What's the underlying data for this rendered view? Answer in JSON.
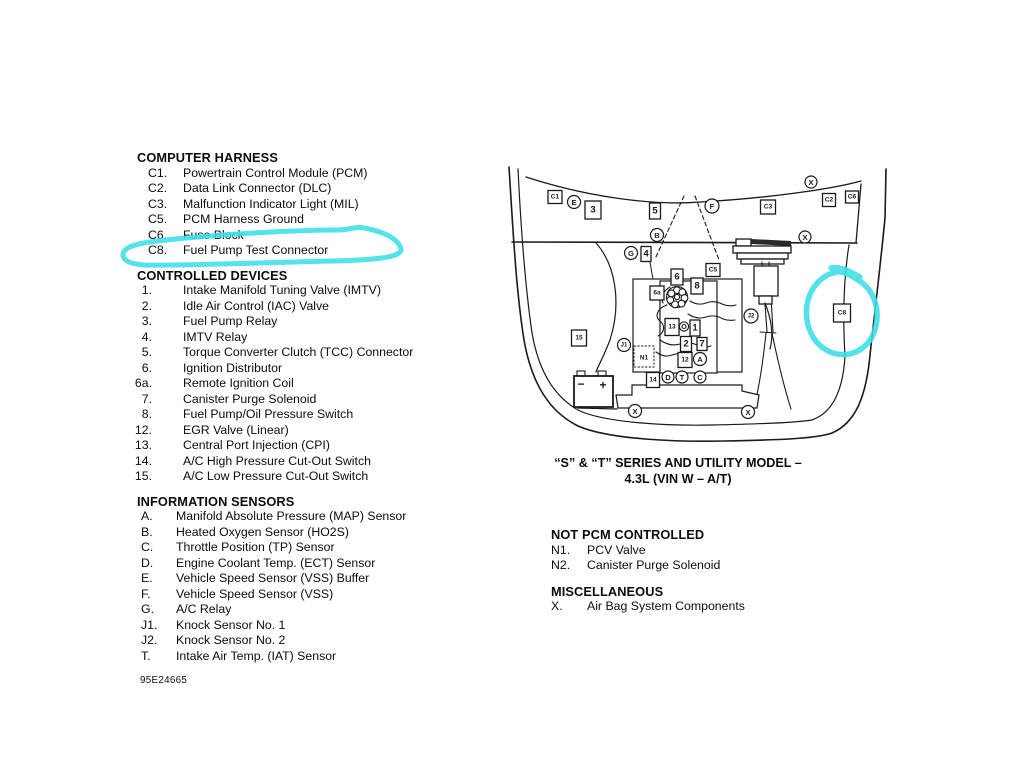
{
  "page": {
    "highlight_color": "#3cdfe8",
    "line_color": "#1a1a1a"
  },
  "legend": {
    "doc_number": "95E24665",
    "sections": [
      {
        "title": "COMPUTER HARNESS",
        "items": [
          {
            "num": "C1.",
            "text": "Powertrain Control Module (PCM)"
          },
          {
            "num": "C2.",
            "text": "Data Link Connector (DLC)"
          },
          {
            "num": "C3.",
            "text": "Malfunction Indicator Light (MIL)"
          },
          {
            "num": "C5.",
            "text": "PCM Harness Ground"
          },
          {
            "num": "C6.",
            "text": "Fuse Block"
          },
          {
            "num": "C8.",
            "text": "Fuel Pump Test Connector"
          }
        ]
      },
      {
        "title": "CONTROLLED DEVICES",
        "items": [
          {
            "num": "1.",
            "text": "Intake Manifold Tuning Valve (IMTV)"
          },
          {
            "num": "2.",
            "text": "Idle Air Control (IAC) Valve"
          },
          {
            "num": "3.",
            "text": "Fuel Pump Relay"
          },
          {
            "num": "4.",
            "text": "IMTV Relay"
          },
          {
            "num": "5.",
            "text": "Torque Converter Clutch (TCC) Connector"
          },
          {
            "num": "6.",
            "text": "Ignition Distributor"
          },
          {
            "num": "6a.",
            "text": "Remote Ignition Coil"
          },
          {
            "num": "7.",
            "text": "Canister Purge Solenoid"
          },
          {
            "num": "8.",
            "text": "Fuel Pump/Oil Pressure Switch"
          },
          {
            "num": "12.",
            "text": "EGR Valve (Linear)"
          },
          {
            "num": "13.",
            "text": "Central Port Injection (CPI)"
          },
          {
            "num": "14.",
            "text": "A/C High Pressure Cut-Out Switch"
          },
          {
            "num": "15.",
            "text": "A/C Low Pressure Cut-Out Switch"
          }
        ]
      },
      {
        "title": "INFORMATION SENSORS",
        "items": [
          {
            "num": "A.",
            "text": "Manifold Absolute Pressure (MAP) Sensor"
          },
          {
            "num": "B.",
            "text": "Heated Oxygen Sensor (HO2S)"
          },
          {
            "num": "C.",
            "text": "Throttle Position (TP) Sensor"
          },
          {
            "num": "D.",
            "text": "Engine Coolant Temp. (ECT) Sensor"
          },
          {
            "num": "E.",
            "text": "Vehicle Speed Sensor (VSS) Buffer"
          },
          {
            "num": "F.",
            "text": "Vehicle Speed Sensor (VSS)"
          },
          {
            "num": "G.",
            "text": "A/C Relay"
          },
          {
            "num": "J1.",
            "text": "Knock Sensor No. 1"
          },
          {
            "num": "J2.",
            "text": "Knock Sensor No. 2"
          },
          {
            "num": "T.",
            "text": "Intake Air Temp. (IAT) Sensor"
          }
        ]
      }
    ]
  },
  "right_legend": {
    "sections": [
      {
        "title": "NOT PCM CONTROLLED",
        "items": [
          {
            "num": "N1.",
            "text": "PCV Valve"
          },
          {
            "num": "N2.",
            "text": "Canister Purge Solenoid"
          }
        ]
      },
      {
        "title": "MISCELLANEOUS",
        "items": [
          {
            "num": "X.",
            "text": "Air Bag System Components"
          }
        ]
      }
    ]
  },
  "diagram": {
    "caption_line1": "“S” & “T” SERIES AND UTILITY MODEL –",
    "caption_line2": "4.3L (VIN W – A/T)",
    "n1_label": "N1",
    "battery": {
      "minus": "−",
      "plus": "+"
    },
    "markers": {
      "squares": [
        {
          "label": "C1",
          "cx": 555,
          "cy": 197,
          "w": 14,
          "h": 13
        },
        {
          "label": "3",
          "cx": 593,
          "cy": 210,
          "w": 16,
          "h": 18
        },
        {
          "label": "5",
          "cx": 655,
          "cy": 211,
          "w": 11,
          "h": 16
        },
        {
          "label": "C3",
          "cx": 768,
          "cy": 207,
          "w": 15,
          "h": 14
        },
        {
          "label": "C2",
          "cx": 829,
          "cy": 200,
          "w": 13,
          "h": 13
        },
        {
          "label": "C6",
          "cx": 852,
          "cy": 197,
          "w": 13,
          "h": 12
        },
        {
          "label": "4",
          "cx": 646,
          "cy": 254,
          "w": 10,
          "h": 15
        },
        {
          "label": "C5",
          "cx": 713,
          "cy": 270,
          "w": 14,
          "h": 13
        },
        {
          "label": "6",
          "cx": 677,
          "cy": 277,
          "w": 12,
          "h": 16
        },
        {
          "label": "6a",
          "cx": 657,
          "cy": 293,
          "w": 14,
          "h": 14
        },
        {
          "label": "8",
          "cx": 697,
          "cy": 286,
          "w": 12,
          "h": 16
        },
        {
          "label": "C8",
          "cx": 842,
          "cy": 313,
          "w": 17,
          "h": 18
        },
        {
          "label": "13",
          "cx": 672,
          "cy": 327,
          "w": 14,
          "h": 17
        },
        {
          "label": "1",
          "cx": 695,
          "cy": 328,
          "w": 10,
          "h": 16
        },
        {
          "label": "2",
          "cx": 686,
          "cy": 344,
          "w": 11,
          "h": 15
        },
        {
          "label": "7",
          "cx": 702,
          "cy": 344,
          "w": 10,
          "h": 13
        },
        {
          "label": "12",
          "cx": 685,
          "cy": 360,
          "w": 14,
          "h": 15
        },
        {
          "label": "15",
          "cx": 579,
          "cy": 338,
          "w": 15,
          "h": 16
        },
        {
          "label": "14",
          "cx": 653,
          "cy": 380,
          "w": 13,
          "h": 15
        }
      ],
      "circles": [
        {
          "label": "E",
          "cx": 574,
          "cy": 202,
          "r": 6.5
        },
        {
          "label": "F",
          "cx": 712,
          "cy": 206,
          "r": 7
        },
        {
          "label": "B",
          "cx": 657,
          "cy": 235,
          "r": 6.5
        },
        {
          "label": "G",
          "cx": 631,
          "cy": 253,
          "r": 6.5
        },
        {
          "label": "X",
          "cx": 811,
          "cy": 182,
          "r": 6
        },
        {
          "label": "X",
          "cx": 805,
          "cy": 237,
          "r": 6
        },
        {
          "label": "J2",
          "cx": 751,
          "cy": 316,
          "r": 7
        },
        {
          "label": "J1",
          "cx": 624,
          "cy": 345,
          "r": 6.5
        },
        {
          "label": "A",
          "cx": 700,
          "cy": 359,
          "r": 6.5
        },
        {
          "label": "D",
          "cx": 668,
          "cy": 377,
          "r": 6
        },
        {
          "label": "T",
          "cx": 682,
          "cy": 377,
          "r": 6
        },
        {
          "label": "C",
          "cx": 700,
          "cy": 377,
          "r": 6
        },
        {
          "label": "X",
          "cx": 635,
          "cy": 411,
          "r": 6.5
        },
        {
          "label": "X",
          "cx": 748,
          "cy": 412,
          "r": 6.5
        }
      ]
    }
  }
}
